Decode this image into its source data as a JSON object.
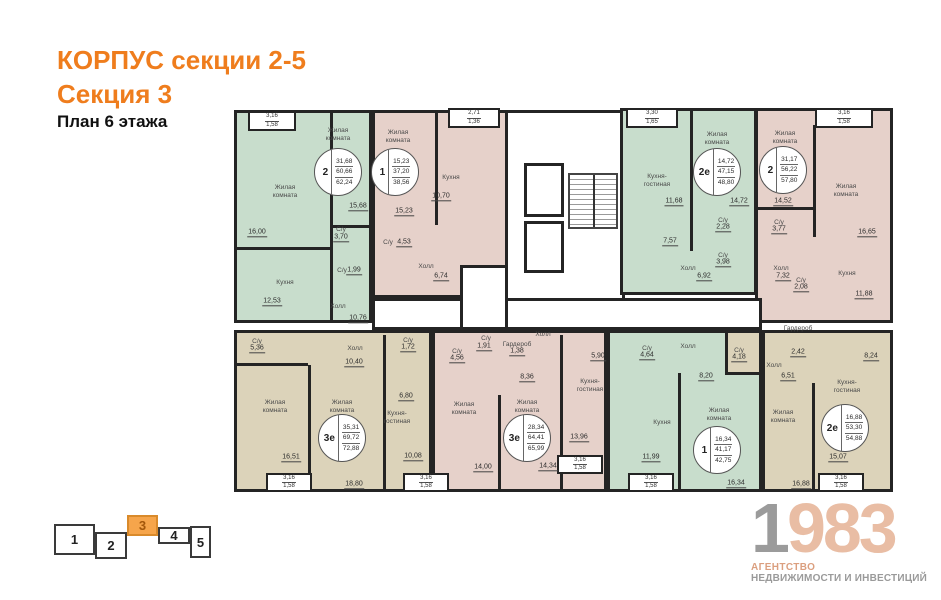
{
  "header": {
    "title": "КОРПУС секции 2-5",
    "section": "Секция 3",
    "floor": "План 6 этажа"
  },
  "colors": {
    "accent_orange": "#ef7d1d",
    "room_green": "#c8ddcc",
    "room_pink": "#e6d1ca",
    "room_beige": "#dcd3ba",
    "wall": "#242424",
    "minimap_active": "#f6a54b",
    "logo_gray": "#9b9b9b",
    "logo_salmon": "#e9bda4"
  },
  "minimap": {
    "sections": [
      {
        "label": "1",
        "active": false
      },
      {
        "label": "2",
        "active": false
      },
      {
        "label": "3",
        "active": true
      },
      {
        "label": "4",
        "active": false
      },
      {
        "label": "5",
        "active": false
      }
    ]
  },
  "logo": {
    "year_gray": "1",
    "year_salmon": "983",
    "tagline1": "АГЕНТСТВО",
    "tagline2": "НЕДВИЖИМОСТИ И ИНВЕСТИЦИЙ"
  },
  "plan": {
    "units": [
      {
        "name": "apartment-2-rooms-top-left",
        "color": "green",
        "x": 4,
        "y": 15,
        "w": 138,
        "h": 213,
        "interactable": true
      },
      {
        "name": "apartment-1-room-top",
        "color": "pink",
        "x": 142,
        "y": 15,
        "w": 136,
        "h": 188,
        "interactable": true
      },
      {
        "name": "building-core",
        "color": "white",
        "x": 275,
        "y": 15,
        "w": 120,
        "h": 220,
        "interactable": false
      },
      {
        "name": "apartment-2e-top",
        "color": "green",
        "x": 390,
        "y": 13,
        "w": 137,
        "h": 187,
        "interactable": true
      },
      {
        "name": "apartment-2-rooms-top-right",
        "color": "pink",
        "x": 525,
        "y": 13,
        "w": 138,
        "h": 215,
        "interactable": true
      },
      {
        "name": "corridor",
        "color": "white",
        "x": 142,
        "y": 203,
        "w": 390,
        "h": 32,
        "interactable": false
      },
      {
        "name": "core-vestibule",
        "color": "white",
        "x": 230,
        "y": 170,
        "w": 48,
        "h": 65,
        "interactable": false
      },
      {
        "name": "apartment-3e-bottom-left",
        "color": "beige",
        "x": 4,
        "y": 235,
        "w": 198,
        "h": 162,
        "interactable": true
      },
      {
        "name": "apartment-3e-bottom-center",
        "color": "pink",
        "x": 202,
        "y": 235,
        "w": 175,
        "h": 162,
        "interactable": true
      },
      {
        "name": "apartment-1-room-bottom",
        "color": "green",
        "x": 377,
        "y": 235,
        "w": 155,
        "h": 162,
        "interactable": true
      },
      {
        "name": "apartment-2e-bottom-right",
        "color": "beige",
        "x": 532,
        "y": 235,
        "w": 131,
        "h": 162,
        "interactable": true
      },
      {
        "name": "apartment-2e-bottom-right-wc",
        "color": "beige",
        "x": 495,
        "y": 235,
        "w": 37,
        "h": 45,
        "interactable": true
      }
    ],
    "walls": [
      {
        "x": 100,
        "y": 18,
        "w": 3,
        "h": 112
      },
      {
        "x": 4,
        "y": 152,
        "w": 98,
        "h": 3
      },
      {
        "x": 100,
        "y": 130,
        "w": 44,
        "h": 3
      },
      {
        "x": 100,
        "y": 133,
        "w": 3,
        "h": 95
      },
      {
        "x": 205,
        "y": 18,
        "w": 3,
        "h": 112
      },
      {
        "x": 460,
        "y": 16,
        "w": 3,
        "h": 140
      },
      {
        "x": 583,
        "y": 30,
        "w": 3,
        "h": 112
      },
      {
        "x": 525,
        "y": 112,
        "w": 60,
        "h": 3
      },
      {
        "x": 153,
        "y": 240,
        "w": 3,
        "h": 155
      },
      {
        "x": 78,
        "y": 270,
        "w": 3,
        "h": 127
      },
      {
        "x": 4,
        "y": 268,
        "w": 74,
        "h": 3
      },
      {
        "x": 268,
        "y": 300,
        "w": 3,
        "h": 97
      },
      {
        "x": 330,
        "y": 240,
        "w": 3,
        "h": 157
      },
      {
        "x": 448,
        "y": 278,
        "w": 3,
        "h": 119
      },
      {
        "x": 582,
        "y": 288,
        "w": 3,
        "h": 109
      }
    ],
    "core": {
      "elevators": [
        {
          "x": 294,
          "y": 68,
          "w": 40,
          "h": 54
        },
        {
          "x": 294,
          "y": 126,
          "w": 40,
          "h": 52
        }
      ],
      "stairs": {
        "x": 338,
        "y": 78,
        "w": 50,
        "h": 56
      }
    },
    "balconies": [
      {
        "x": 18,
        "y": 16,
        "w": 48,
        "h": 20,
        "v1": "3,16",
        "v2": "1,58"
      },
      {
        "x": 218,
        "y": 13,
        "w": 52,
        "h": 20,
        "v1": "2,71",
        "v2": "1,36"
      },
      {
        "x": 396,
        "y": 13,
        "w": 52,
        "h": 20,
        "v1": "3,30",
        "v2": "1,65"
      },
      {
        "x": 585,
        "y": 13,
        "w": 58,
        "h": 20,
        "v1": "3,16",
        "v2": "1,58"
      },
      {
        "x": 36,
        "y": 378,
        "w": 46,
        "h": 19,
        "v1": "3,16",
        "v2": "1,58"
      },
      {
        "x": 173,
        "y": 378,
        "w": 46,
        "h": 19,
        "v1": "3,16",
        "v2": "1,58"
      },
      {
        "x": 327,
        "y": 360,
        "w": 46,
        "h": 19,
        "v1": "3,16",
        "v2": "1,58"
      },
      {
        "x": 398,
        "y": 378,
        "w": 46,
        "h": 19,
        "v1": "3,16",
        "v2": "1,58"
      },
      {
        "x": 588,
        "y": 378,
        "w": 46,
        "h": 19,
        "v1": "3,16",
        "v2": "1,58"
      }
    ],
    "labels": [
      {
        "t": "Жилая\nкомната",
        "x": 55,
        "y": 97
      },
      {
        "t": "Кухня",
        "x": 55,
        "y": 188
      },
      {
        "t": "Жилая\nкомната",
        "x": 108,
        "y": 40
      },
      {
        "t": "С/у",
        "x": 111,
        "y": 135
      },
      {
        "t": "С/у",
        "x": 112,
        "y": 176
      },
      {
        "t": "Холл",
        "x": 108,
        "y": 212
      },
      {
        "t": "Жилая\nкомната",
        "x": 168,
        "y": 42
      },
      {
        "t": "Кухня",
        "x": 221,
        "y": 83
      },
      {
        "t": "С/у",
        "x": 158,
        "y": 148
      },
      {
        "t": "Холл",
        "x": 196,
        "y": 172
      },
      {
        "t": "Кухня-\nгостиная",
        "x": 427,
        "y": 86
      },
      {
        "t": "Жилая\nкомната",
        "x": 487,
        "y": 44
      },
      {
        "t": "С/у",
        "x": 493,
        "y": 126
      },
      {
        "t": "С/у",
        "x": 493,
        "y": 161
      },
      {
        "t": "Холл",
        "x": 458,
        "y": 174
      },
      {
        "t": "Жилая\nкомната",
        "x": 555,
        "y": 43
      },
      {
        "t": "Жилая\nкомната",
        "x": 616,
        "y": 96
      },
      {
        "t": "С/у",
        "x": 549,
        "y": 128
      },
      {
        "t": "Холл",
        "x": 551,
        "y": 174
      },
      {
        "t": "С/у",
        "x": 571,
        "y": 186
      },
      {
        "t": "Кухня",
        "x": 617,
        "y": 179
      },
      {
        "t": "С/у",
        "x": 27,
        "y": 247
      },
      {
        "t": "Холл",
        "x": 125,
        "y": 254
      },
      {
        "t": "Жилая\nкомната",
        "x": 45,
        "y": 312
      },
      {
        "t": "Жилая\nкомната",
        "x": 112,
        "y": 312
      },
      {
        "t": "С/у",
        "x": 178,
        "y": 246
      },
      {
        "t": "Кухня-\nгостиная",
        "x": 167,
        "y": 323
      },
      {
        "t": "С/у",
        "x": 227,
        "y": 257
      },
      {
        "t": "С/у",
        "x": 256,
        "y": 244
      },
      {
        "t": "Гардероб",
        "x": 287,
        "y": 250
      },
      {
        "t": "Холл",
        "x": 313,
        "y": 240
      },
      {
        "t": "Жилая\nкомната",
        "x": 234,
        "y": 314
      },
      {
        "t": "Жилая\nкомната",
        "x": 297,
        "y": 312
      },
      {
        "t": "Кухня-\nгостиная",
        "x": 360,
        "y": 291
      },
      {
        "t": "С/у",
        "x": 417,
        "y": 254
      },
      {
        "t": "Холл",
        "x": 458,
        "y": 252
      },
      {
        "t": "Кухня",
        "x": 432,
        "y": 328
      },
      {
        "t": "Жилая\nкомната",
        "x": 489,
        "y": 320
      },
      {
        "t": "С/у",
        "x": 509,
        "y": 256
      },
      {
        "t": "Гардероб",
        "x": 568,
        "y": 234
      },
      {
        "t": "Холл",
        "x": 544,
        "y": 271
      },
      {
        "t": "Кухня-\nгостиная",
        "x": 617,
        "y": 292
      },
      {
        "t": "Жилая\nкомната",
        "x": 553,
        "y": 322
      }
    ],
    "areas": [
      {
        "v": "16,00",
        "x": 27,
        "y": 138
      },
      {
        "v": "12,53",
        "x": 42,
        "y": 207
      },
      {
        "v": "15,68",
        "x": 128,
        "y": 112
      },
      {
        "v": "3,70",
        "x": 111,
        "y": 143
      },
      {
        "v": "1,99",
        "x": 124,
        "y": 176
      },
      {
        "v": "10,76",
        "x": 128,
        "y": 224
      },
      {
        "v": "15,23",
        "x": 174,
        "y": 117
      },
      {
        "v": "10,70",
        "x": 211,
        "y": 102
      },
      {
        "v": "4,53",
        "x": 174,
        "y": 148
      },
      {
        "v": "6,74",
        "x": 211,
        "y": 182
      },
      {
        "v": "11,68",
        "x": 444,
        "y": 107
      },
      {
        "v": "7,57",
        "x": 440,
        "y": 147
      },
      {
        "v": "14,72",
        "x": 509,
        "y": 107
      },
      {
        "v": "2,28",
        "x": 493,
        "y": 133
      },
      {
        "v": "3,98",
        "x": 493,
        "y": 168
      },
      {
        "v": "6,92",
        "x": 474,
        "y": 182
      },
      {
        "v": "14,52",
        "x": 553,
        "y": 107
      },
      {
        "v": "16,65",
        "x": 637,
        "y": 138
      },
      {
        "v": "3,77",
        "x": 549,
        "y": 135
      },
      {
        "v": "7,32",
        "x": 553,
        "y": 182
      },
      {
        "v": "2,08",
        "x": 571,
        "y": 193
      },
      {
        "v": "11,88",
        "x": 634,
        "y": 200
      },
      {
        "v": "5,36",
        "x": 27,
        "y": 254
      },
      {
        "v": "10,40",
        "x": 124,
        "y": 268
      },
      {
        "v": "16,51",
        "x": 61,
        "y": 363
      },
      {
        "v": "18,80",
        "x": 124,
        "y": 390
      },
      {
        "v": "1,72",
        "x": 178,
        "y": 253
      },
      {
        "v": "6,80",
        "x": 176,
        "y": 302
      },
      {
        "v": "10,08",
        "x": 183,
        "y": 362
      },
      {
        "v": "4,56",
        "x": 227,
        "y": 264
      },
      {
        "v": "1,91",
        "x": 254,
        "y": 252
      },
      {
        "v": "1,38",
        "x": 287,
        "y": 257
      },
      {
        "v": "8,36",
        "x": 297,
        "y": 283
      },
      {
        "v": "14,00",
        "x": 253,
        "y": 373
      },
      {
        "v": "14,34",
        "x": 318,
        "y": 372
      },
      {
        "v": "5,90",
        "x": 368,
        "y": 262
      },
      {
        "v": "13,96",
        "x": 349,
        "y": 343
      },
      {
        "v": "4,64",
        "x": 417,
        "y": 261
      },
      {
        "v": "8,20",
        "x": 476,
        "y": 282
      },
      {
        "v": "11,99",
        "x": 421,
        "y": 363
      },
      {
        "v": "16,34",
        "x": 506,
        "y": 389
      },
      {
        "v": "4,18",
        "x": 509,
        "y": 263
      },
      {
        "v": "2,42",
        "x": 568,
        "y": 258
      },
      {
        "v": "6,51",
        "x": 558,
        "y": 282
      },
      {
        "v": "8,24",
        "x": 641,
        "y": 262
      },
      {
        "v": "15,07",
        "x": 608,
        "y": 363
      },
      {
        "v": "16,88",
        "x": 571,
        "y": 390
      }
    ],
    "stats": [
      {
        "rooms": "2",
        "values": [
          "31,68",
          "60,66",
          "62,24"
        ],
        "x": 108,
        "y": 77
      },
      {
        "rooms": "1",
        "values": [
          "15,23",
          "37,20",
          "38,56"
        ],
        "x": 165,
        "y": 77
      },
      {
        "rooms": "2е",
        "values": [
          "14,72",
          "47,15",
          "48,80"
        ],
        "x": 487,
        "y": 77
      },
      {
        "rooms": "2",
        "values": [
          "31,17",
          "56,22",
          "57,80"
        ],
        "x": 553,
        "y": 75
      },
      {
        "rooms": "3е",
        "values": [
          "35,31",
          "69,72",
          "72,88"
        ],
        "x": 112,
        "y": 343
      },
      {
        "rooms": "3е",
        "values": [
          "28,34",
          "64,41",
          "65,99"
        ],
        "x": 297,
        "y": 343
      },
      {
        "rooms": "1",
        "values": [
          "16,34",
          "41,17",
          "42,75"
        ],
        "x": 487,
        "y": 355
      },
      {
        "rooms": "2е",
        "values": [
          "16,88",
          "53,30",
          "54,88"
        ],
        "x": 615,
        "y": 333
      }
    ]
  }
}
